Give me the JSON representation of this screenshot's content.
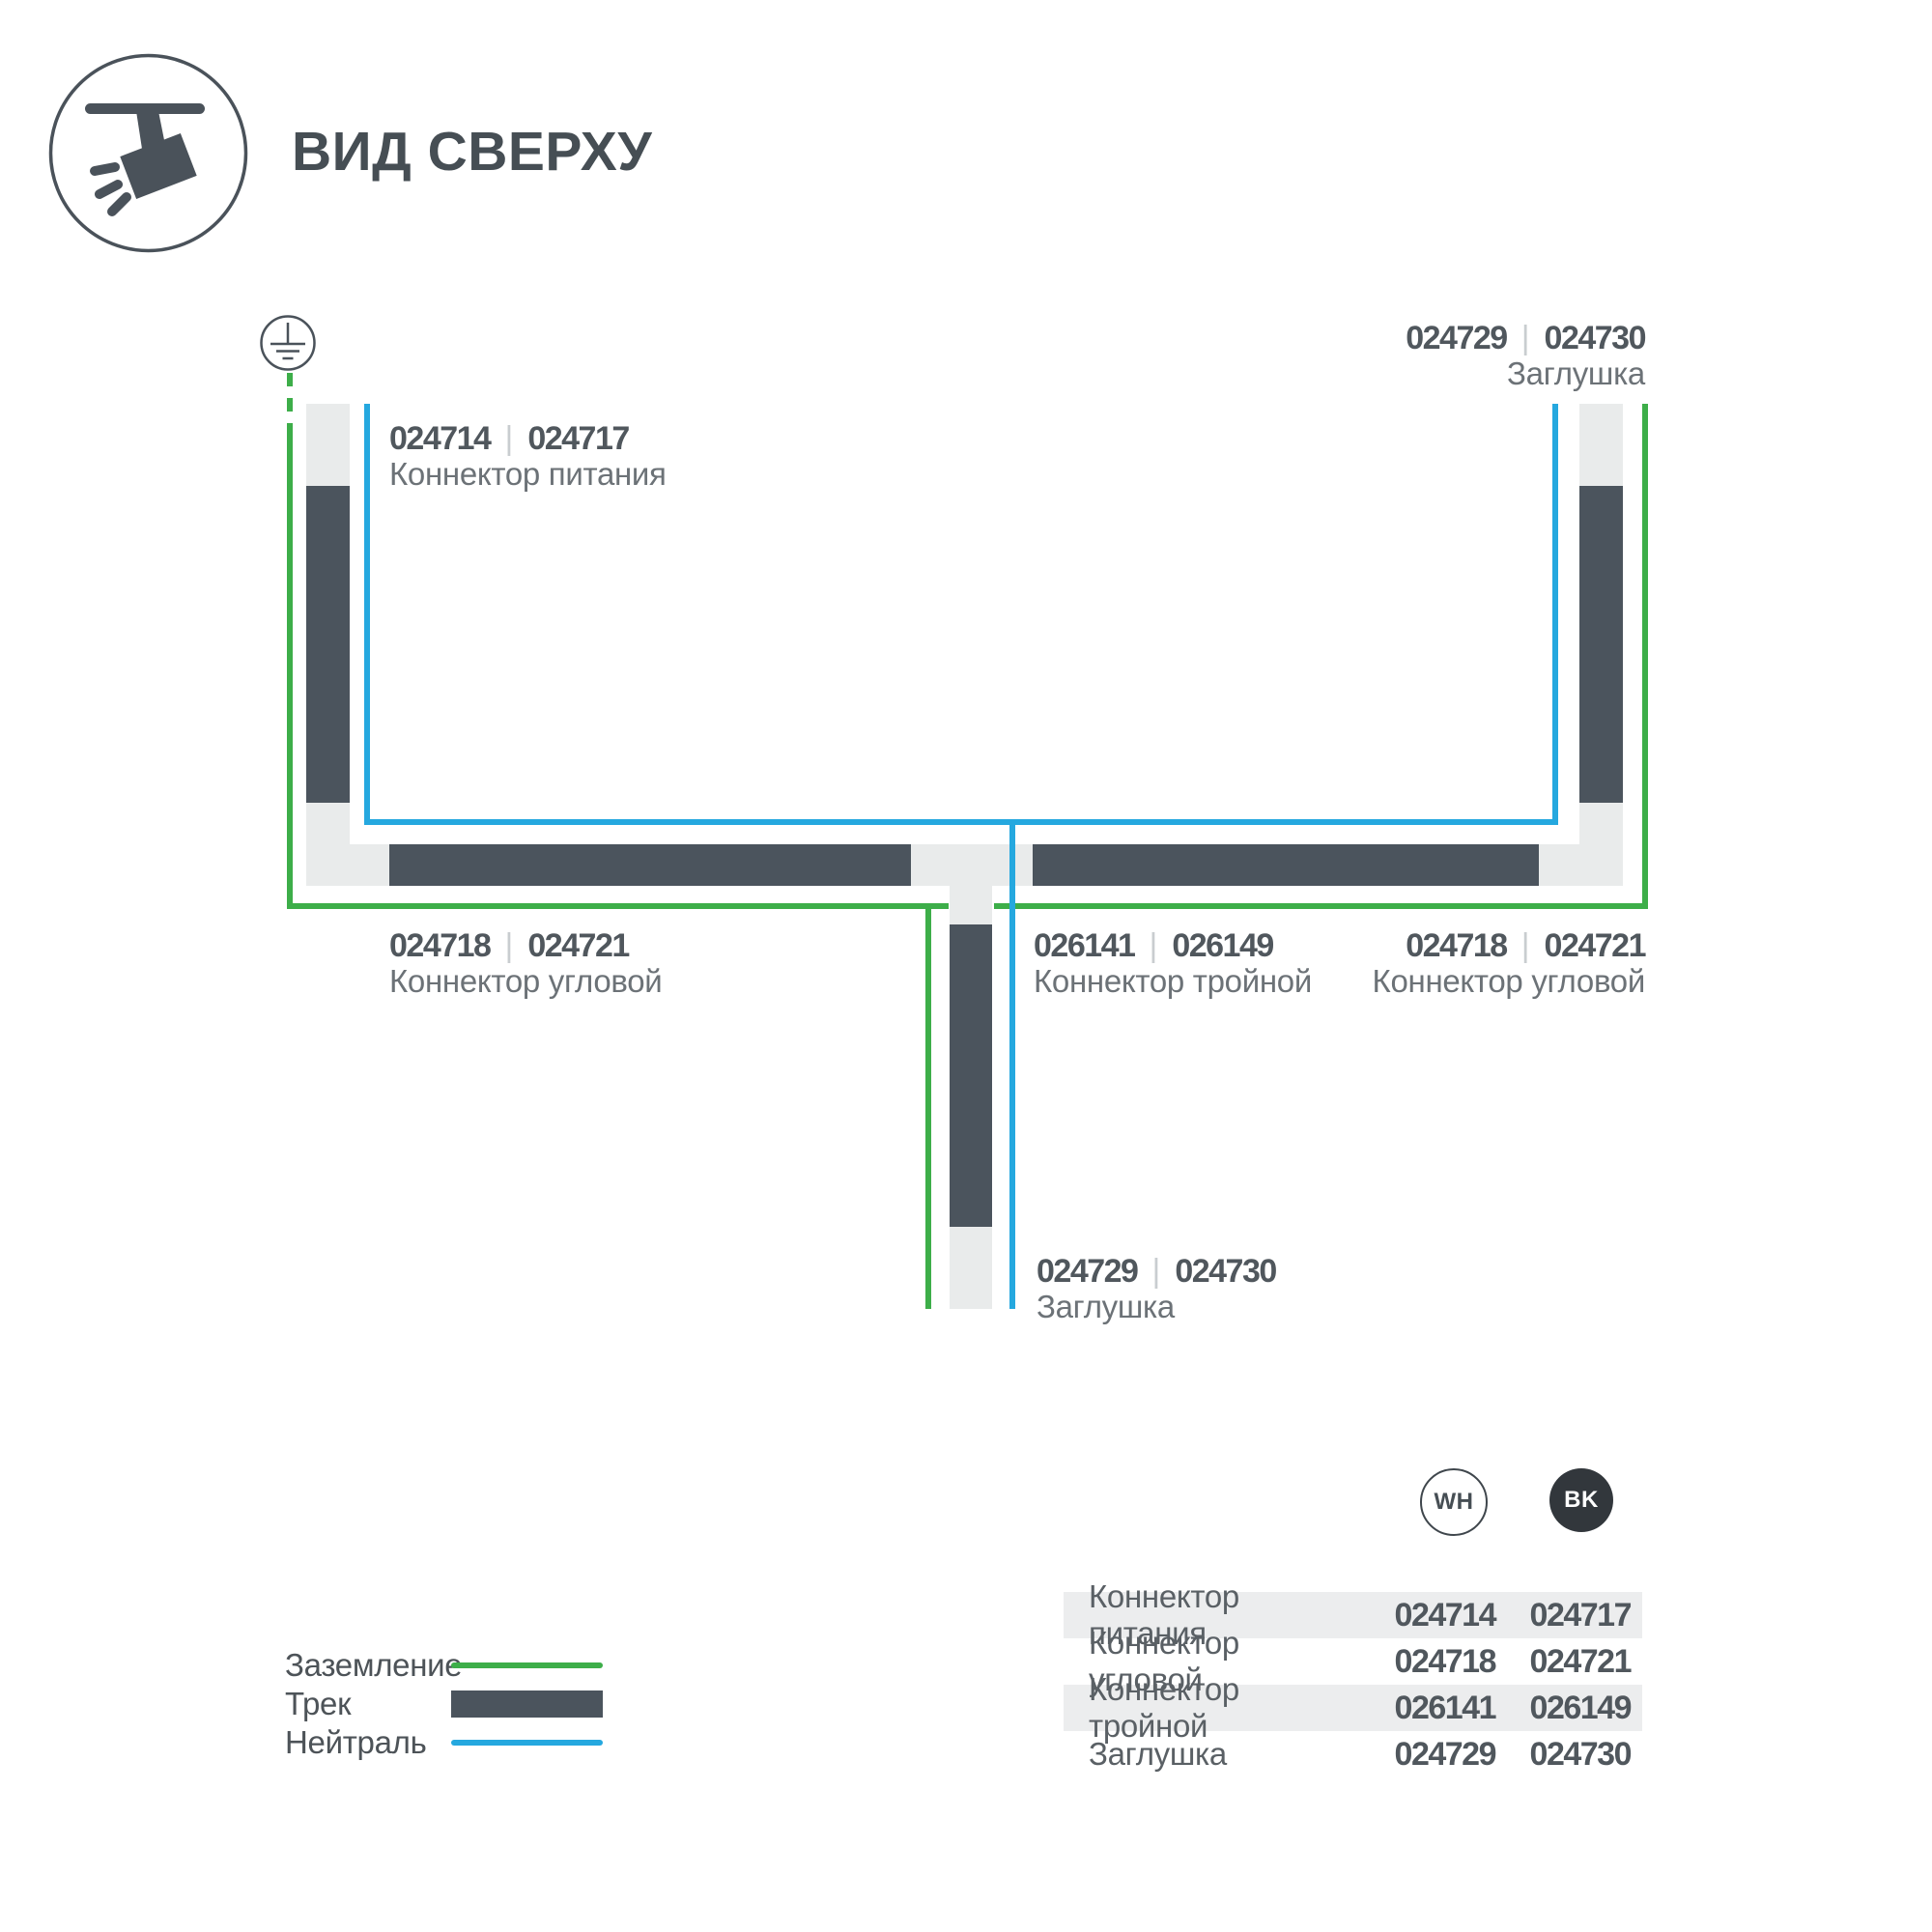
{
  "ui": {
    "separator": "|"
  },
  "header": {
    "title": "ВИД СВЕРХУ"
  },
  "diagram": {
    "power_connector": {
      "code_wh": "024714",
      "code_bk": "024717",
      "name": "Коннектор питания"
    },
    "end_cap_top": {
      "code_wh": "024729",
      "code_bk": "024730",
      "name": "Заглушка"
    },
    "corner_left": {
      "code_wh": "024718",
      "code_bk": "024721",
      "name": "Коннектор угловой"
    },
    "tee_connector": {
      "code_wh": "026141",
      "code_bk": "026149",
      "name": "Коннектор тройной"
    },
    "corner_right": {
      "code_wh": "024718",
      "code_bk": "024721",
      "name": "Коннектор угловой"
    },
    "end_cap_bottom": {
      "code_wh": "024729",
      "code_bk": "024730",
      "name": "Заглушка"
    }
  },
  "legend": {
    "ground": "Заземление",
    "track": "Трек",
    "neutral": "Нейтраль"
  },
  "variants": {
    "white": "WH",
    "black": "BK"
  },
  "table": {
    "rows": [
      {
        "name": "Коннектор питания",
        "wh": "024714",
        "bk": "024717"
      },
      {
        "name": "Коннектор угловой",
        "wh": "024718",
        "bk": "024721"
      },
      {
        "name": "Коннектор тройной",
        "wh": "026141",
        "bk": "026149"
      },
      {
        "name": "Заглушка",
        "wh": "024729",
        "bk": "024730"
      }
    ]
  },
  "colors": {
    "ground": "#3dae49",
    "neutral": "#25a8df",
    "track": "#4b545d",
    "connector_light": "#e9ebeb",
    "row_alt": "#ecedee",
    "text_dark": "#464e54",
    "text_gray": "#6c7277"
  }
}
